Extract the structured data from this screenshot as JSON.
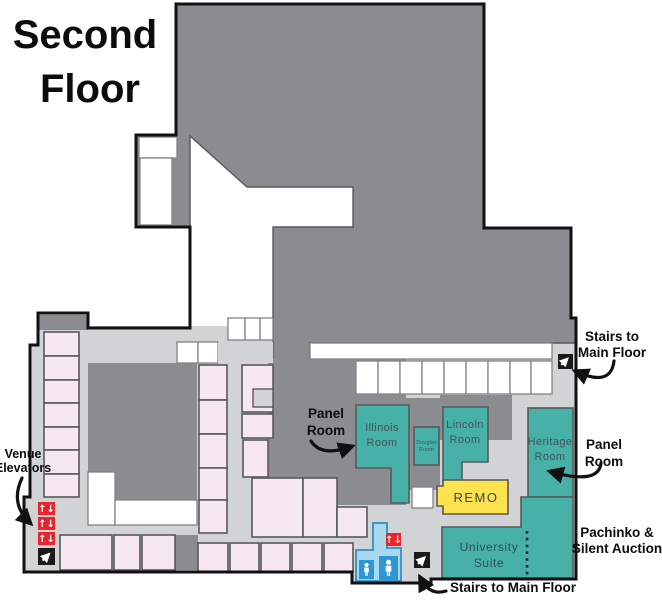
{
  "title": {
    "line1": "Second",
    "line2": "Floor"
  },
  "labels": {
    "stairs_top": {
      "line1": "Stairs to",
      "line2": "Main Floor"
    },
    "panel_left": {
      "line1": "Panel",
      "line2": "Room"
    },
    "panel_right": {
      "line1": "Panel",
      "line2": "Room"
    },
    "venue_elevators": {
      "line1": "Venue",
      "line2": "Elevators"
    },
    "pachinko": {
      "line1": "Pachinko &",
      "line2": "Silent Auction"
    },
    "stairs_bottom": "Stairs to Main Floor"
  },
  "rooms": {
    "illinois": {
      "line1": "Illinois",
      "line2": "Room"
    },
    "douglas": {
      "line1": "Douglas",
      "line2": "Room"
    },
    "lincoln": {
      "line1": "Lincoln",
      "line2": "Room"
    },
    "heritage": {
      "line1": "Heritage",
      "line2": "Room"
    },
    "remo": "REMO",
    "university": {
      "line1": "University",
      "line2": "Suite"
    }
  },
  "icons": {
    "elevator_glyph": "↑↓",
    "elevator_name": "elevator-icon",
    "stairs_name": "stairs-icon",
    "restroom_name": "restroom-person-icon"
  },
  "colors": {
    "dark_gray": "#8b8c8f",
    "light_gray": "#d2d3d5",
    "pink": "#f6e7f0",
    "teal": "#47b1a8",
    "yellow": "#fce24e",
    "red": "#e8252d",
    "restroom_blue": "#a9d7ee",
    "restroom_blue_dark": "#2e96d2",
    "outline_black": "#111111",
    "room_outline": "#58595b"
  }
}
